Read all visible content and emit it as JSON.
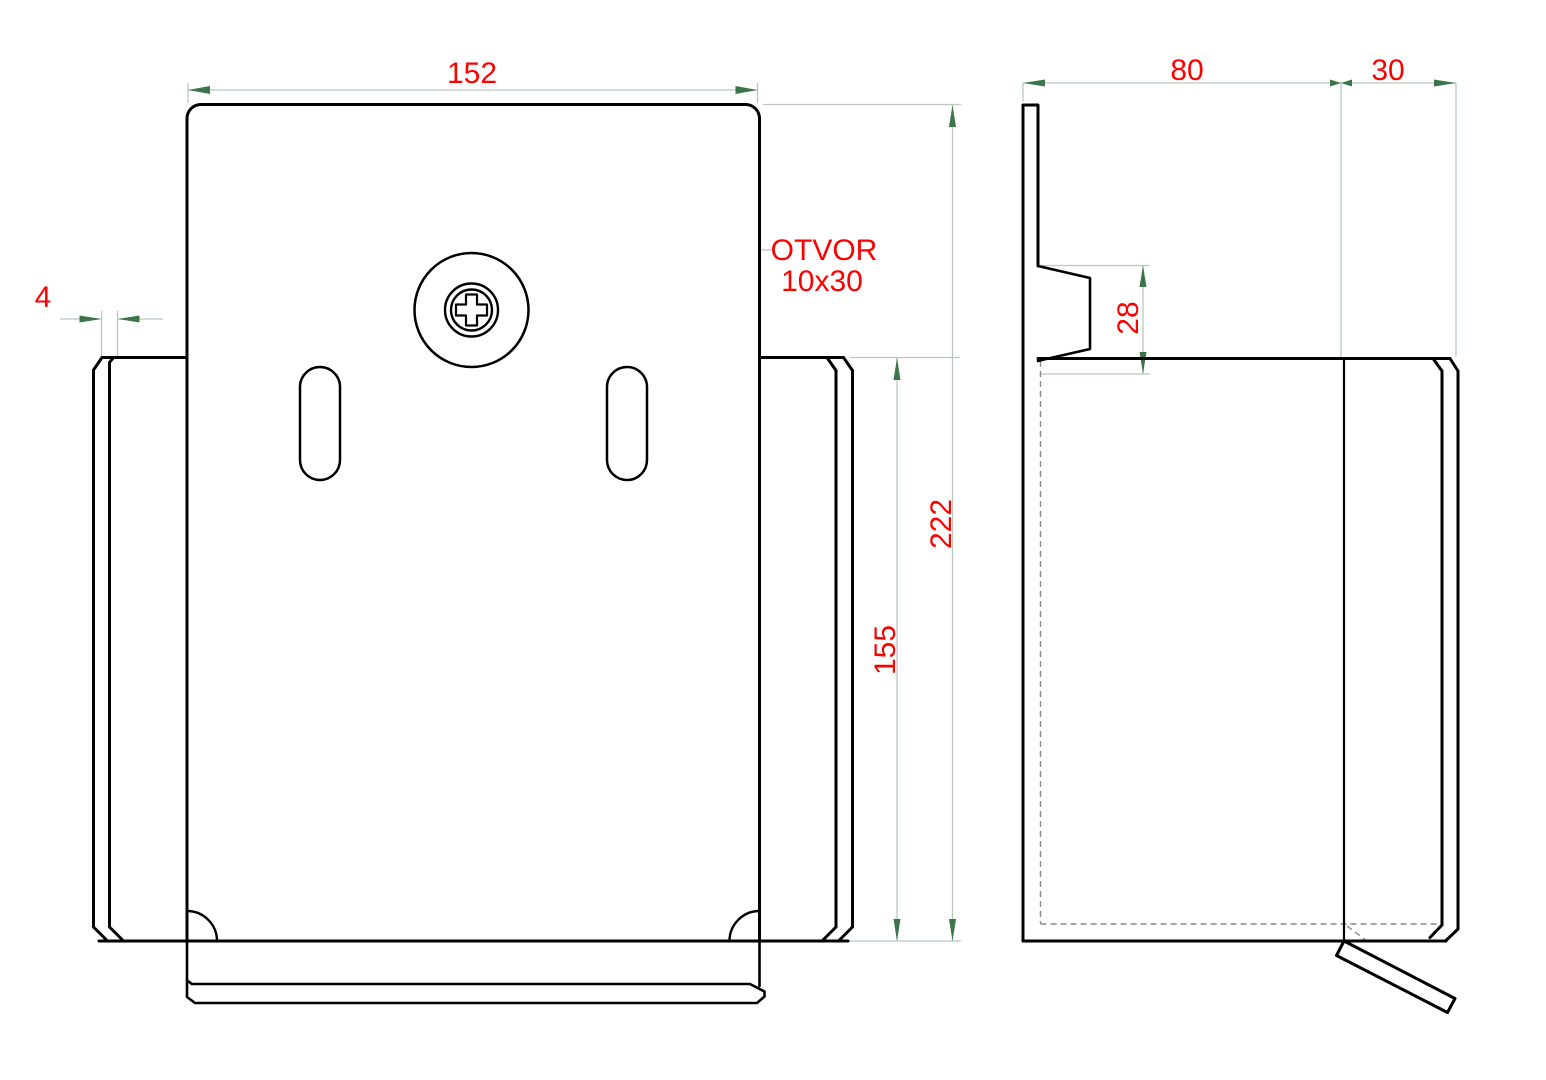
{
  "drawing": {
    "front_view": {
      "dim_width": "152",
      "dim_flange_thickness": "4",
      "dim_side_flange_height": "155",
      "dim_total_height": "222",
      "callout_line1": "OTVOR",
      "callout_line2": "10x30"
    },
    "side_view": {
      "dim_depth": "80",
      "dim_front_return": "30",
      "dim_dimple_height": "28"
    },
    "colors": {
      "background": "#ffffff",
      "geometry": "#000000",
      "dimension_text": "#fe0000",
      "arrow": "#3b7549",
      "extension_line": "#b7c9bc",
      "hidden_line": "#8a8a8a"
    }
  }
}
